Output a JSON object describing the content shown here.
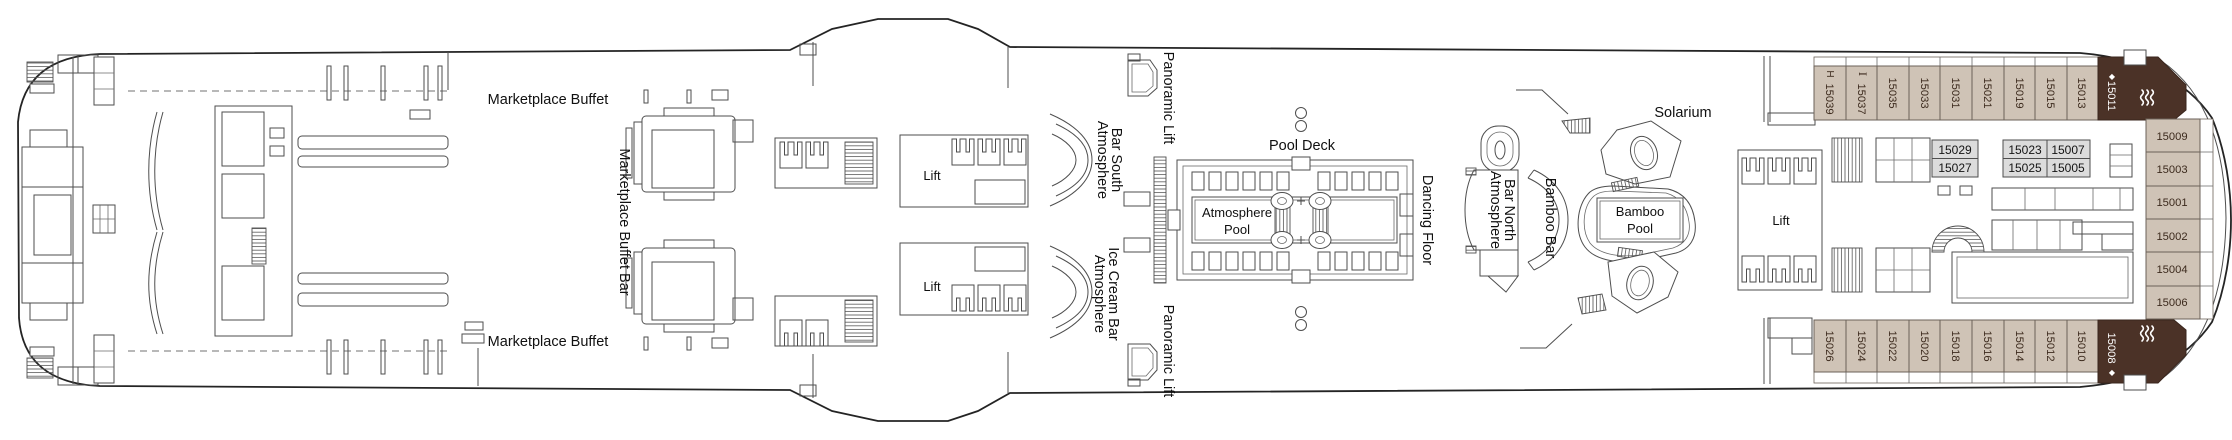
{
  "colors": {
    "outside_cabin_fill": "#cfc3b6",
    "inside_cabin_fill": "#dcdcdc",
    "suite_fill": "#4b3227",
    "cabin_number_text": "#3c2a1d",
    "line_color": "#4e4e4e",
    "background": "#ffffff"
  },
  "venues": {
    "marketplace_buffet_top": "Marketplace Buffet",
    "marketplace_buffet_bottom": "Marketplace Buffet",
    "marketplace_buffet_bar": "Marketplace Buffet Bar",
    "lift_aft_top": "Lift",
    "lift_aft_bottom": "Lift",
    "lift_forward": "Lift",
    "panoramic_lift_top": "Panoramic Lift",
    "panoramic_lift_bottom": "Panoramic Lift",
    "atmosphere_bar_south_line1": "Atmosphere",
    "atmosphere_bar_south_line2": "Bar South",
    "atmosphere_ice_cream_bar_line1": "Atmosphere",
    "atmosphere_ice_cream_bar_line2": "Ice Cream Bar",
    "pool_deck": "Pool Deck",
    "atmosphere_pool_line1": "Atmosphere",
    "atmosphere_pool_line2": "Pool",
    "dancing_floor": "Dancing Floor",
    "atmosphere_bar_north_line1": "Atmosphere",
    "atmosphere_bar_north_line2": "Bar North",
    "bamboo_bar": "Bamboo Bar",
    "solarium": "Solarium",
    "bamboo_pool_line1": "Bamboo",
    "bamboo_pool_line2": "Pool"
  },
  "cabins": {
    "top_row": [
      "15039",
      "15037",
      "15035",
      "15033",
      "15031",
      "15021",
      "15019",
      "15015",
      "15013"
    ],
    "top_suite": "15011",
    "bottom_row": [
      "15026",
      "15024",
      "15022",
      "15020",
      "15018",
      "15016",
      "15014",
      "15012",
      "15010"
    ],
    "bottom_suite": "15008",
    "bow_column": [
      "15009",
      "15003",
      "15001",
      "15002",
      "15004",
      "15006"
    ],
    "inside_blocks": [
      [
        "15029",
        "15027"
      ],
      [
        "15023",
        "15025"
      ],
      [
        "15007",
        "15005"
      ]
    ],
    "accessible_symbol": "H",
    "sofa_symbol": "I",
    "suite_diamond": "◆"
  }
}
